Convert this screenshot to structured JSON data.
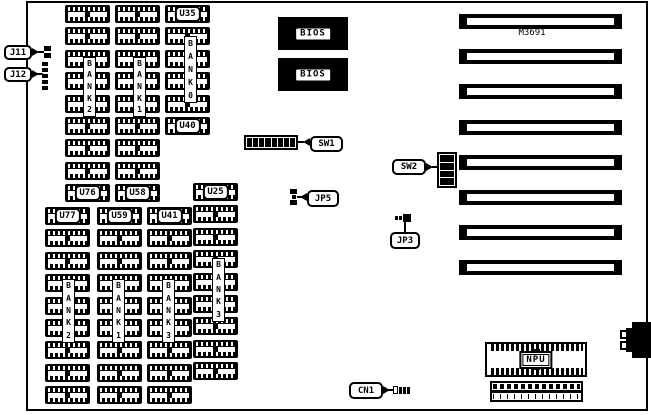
{
  "board": {
    "chipset_label": "M3691"
  },
  "labels": {
    "j11": "J11",
    "j12": "J12",
    "sw1": "SW1",
    "sw2": "SW2",
    "jp5": "JP5",
    "jp3": "JP3",
    "cn1": "CN1",
    "npu": "NPU",
    "bios": "BIOS"
  },
  "switches": {
    "sw1_positions": 8,
    "sw2_positions": 4
  },
  "slots": {
    "count": 8,
    "x": 459,
    "y_first": 14,
    "pitch": 35.2,
    "w": 163,
    "h": 15
  },
  "memory_layout": {
    "chip_w": 45,
    "chip_h": 18,
    "pitch": 22.4,
    "columns": [
      {
        "name": "bank2-upper",
        "bank_label": "BANK2",
        "x": 65,
        "y": 5,
        "count": 9,
        "strip": {
          "x": 83,
          "y": 57,
          "h": 60
        },
        "chip_labels": {
          "8": "U76"
        }
      },
      {
        "name": "bank1-upper",
        "bank_label": "BANK1",
        "x": 115,
        "y": 5,
        "count": 9,
        "strip": {
          "x": 133,
          "y": 57,
          "h": 60
        },
        "chip_labels": {
          "8": "U58"
        }
      },
      {
        "name": "bank0-upper",
        "bank_label": "BANK0",
        "x": 165,
        "y": 5,
        "count": 6,
        "strip": {
          "x": 184,
          "y": 36,
          "h": 67
        },
        "chip_labels": {
          "0": "U35",
          "5": "U40"
        }
      },
      {
        "name": "bank2-lower",
        "bank_label": "BANK2",
        "x": 45,
        "y": 207,
        "count": 9,
        "strip": {
          "x": 62,
          "y": 279,
          "h": 64
        },
        "chip_labels": {
          "0": "U77"
        }
      },
      {
        "name": "bank1-lower",
        "bank_label": "BANK1",
        "x": 97,
        "y": 207,
        "count": 9,
        "strip": {
          "x": 112,
          "y": 279,
          "h": 64
        },
        "chip_labels": {
          "0": "U59"
        }
      },
      {
        "name": "bank3-lower-a",
        "bank_label": "BANK3",
        "x": 147,
        "y": 207,
        "count": 9,
        "strip": {
          "x": 162,
          "y": 279,
          "h": 64
        },
        "chip_labels": {
          "0": "U41"
        }
      },
      {
        "name": "bank3-lower-b",
        "bank_label": "BANK3",
        "x": 193,
        "y": 183,
        "count": 9,
        "strip": {
          "x": 212,
          "y": 258,
          "h": 64
        },
        "chip_labels": {
          "0": "U25"
        }
      }
    ]
  }
}
